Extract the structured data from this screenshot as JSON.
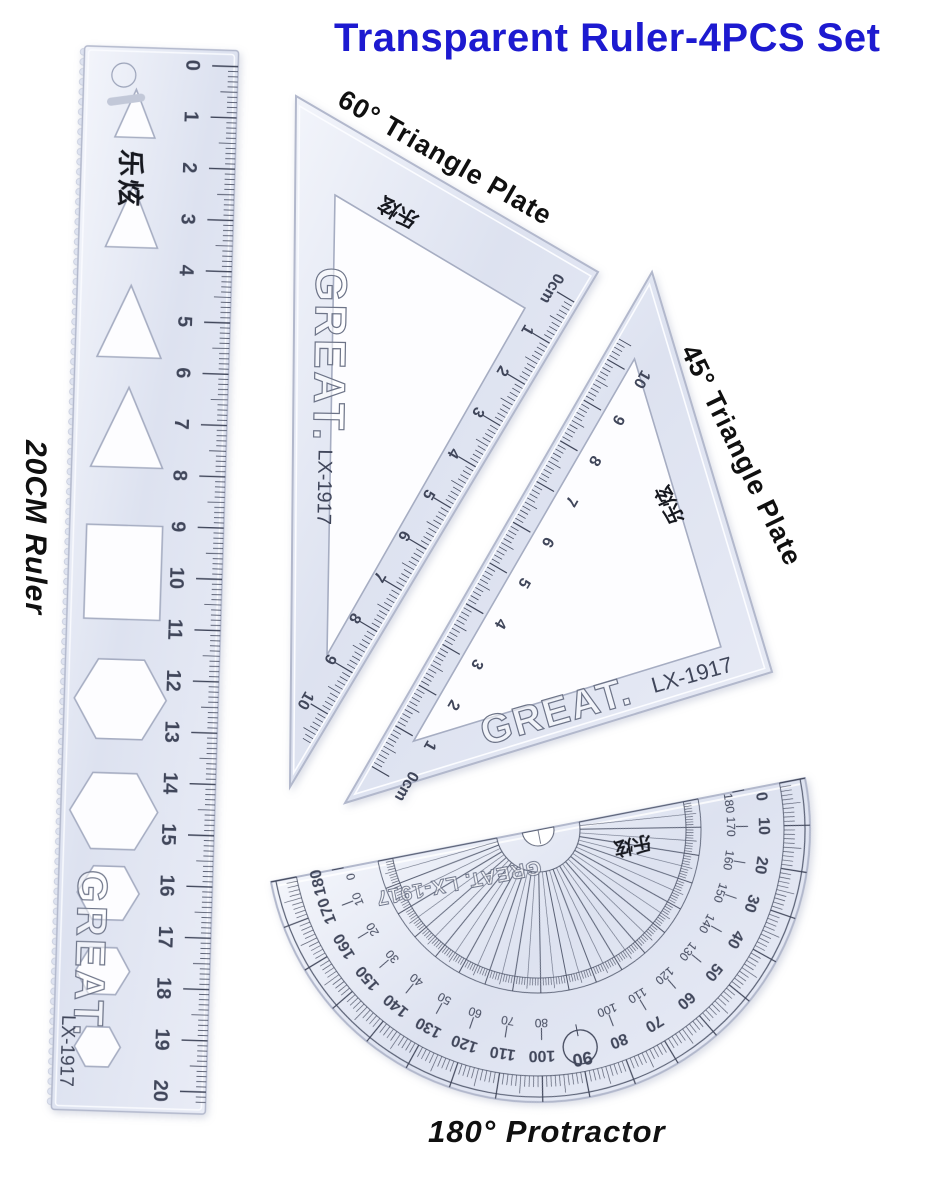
{
  "title": {
    "text": "Transparent Ruler-4PCS Set",
    "color": "#1d1ad0"
  },
  "products": {
    "ruler": {
      "label": "20CM Ruler",
      "brand": "GREAT.",
      "model": "LX-1917",
      "brand_cn": "乐炫",
      "unit": "cm",
      "numbers": [
        0,
        1,
        2,
        3,
        4,
        5,
        6,
        7,
        8,
        9,
        10,
        11,
        12,
        13,
        14,
        15,
        16,
        17,
        18,
        19,
        20
      ]
    },
    "tri60": {
      "label": "60° Triangle Plate",
      "brand": "GREAT.",
      "model": "LX-1917",
      "brand_cn": "乐炫",
      "scale": [
        "0cm",
        "1",
        "2",
        "3",
        "4",
        "5",
        "6",
        "7",
        "8",
        "9",
        "10"
      ]
    },
    "tri45": {
      "label": "45° Triangle Plate",
      "brand": "GREAT.",
      "model": "LX-1917",
      "brand_cn": "乐炫",
      "scale": [
        "0cm",
        "1",
        "2",
        "3",
        "4",
        "5",
        "6",
        "7",
        "8",
        "9",
        "10"
      ]
    },
    "protractor": {
      "label": "180° Protractor",
      "brand": "GREAT. LX-1917",
      "brand_cn": "乐炫",
      "outer_degrees": [
        0,
        10,
        20,
        30,
        40,
        50,
        60,
        70,
        80,
        90,
        100,
        110,
        120,
        130,
        140,
        150,
        160,
        170,
        180
      ],
      "inner_degrees": [
        180,
        170,
        160,
        150,
        140,
        130,
        120,
        110,
        100,
        90,
        80,
        70,
        60,
        50,
        40,
        30,
        20,
        10,
        0
      ],
      "circled_degree": "90"
    }
  },
  "colors": {
    "plastic_hi": "#f3f5fb",
    "plastic": "#dde2f0",
    "plastic_lo": "#e9ecf6",
    "edge": "#b2b8cc",
    "marks": "#40465a",
    "brand_outline": "#6d7488",
    "ink": "#16181f",
    "cutout_stroke": "#a6adc2",
    "cutout_fill": "#fdfdff"
  }
}
